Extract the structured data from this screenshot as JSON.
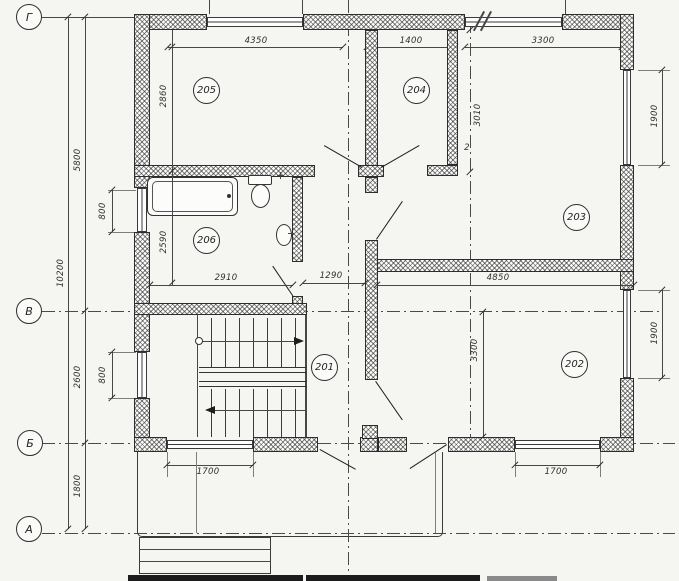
{
  "meta": {
    "drawing_type": "architectural floor plan, second storey",
    "paper_color": "#f5f5f2",
    "ink_color": "#2e2e2e"
  },
  "axes": {
    "g": "Г",
    "v": "В",
    "b": "Б",
    "a": "А",
    "axis2": "2"
  },
  "rooms": {
    "r201": "201",
    "r202": "202",
    "r203": "203",
    "r204": "204",
    "r205": "205",
    "r206": "206"
  },
  "dims": {
    "top": {
      "d4350": "4350",
      "d1400": "1400",
      "d3300": "3300"
    },
    "left": {
      "total": "10200",
      "s5800": "5800",
      "s2600": "2600",
      "s1800": "1800",
      "w800a": "800",
      "w800b": "800"
    },
    "right": {
      "win1900a": "1900",
      "win1900b": "1900"
    },
    "inner": {
      "d2860": "2860",
      "d2590": "2590",
      "d2910": "2910",
      "d1290": "1290",
      "d3010": "3010",
      "d4850": "4850",
      "d3300v": "3300"
    },
    "bottom": {
      "d1700a": "1700",
      "d1700b": "1700"
    }
  }
}
